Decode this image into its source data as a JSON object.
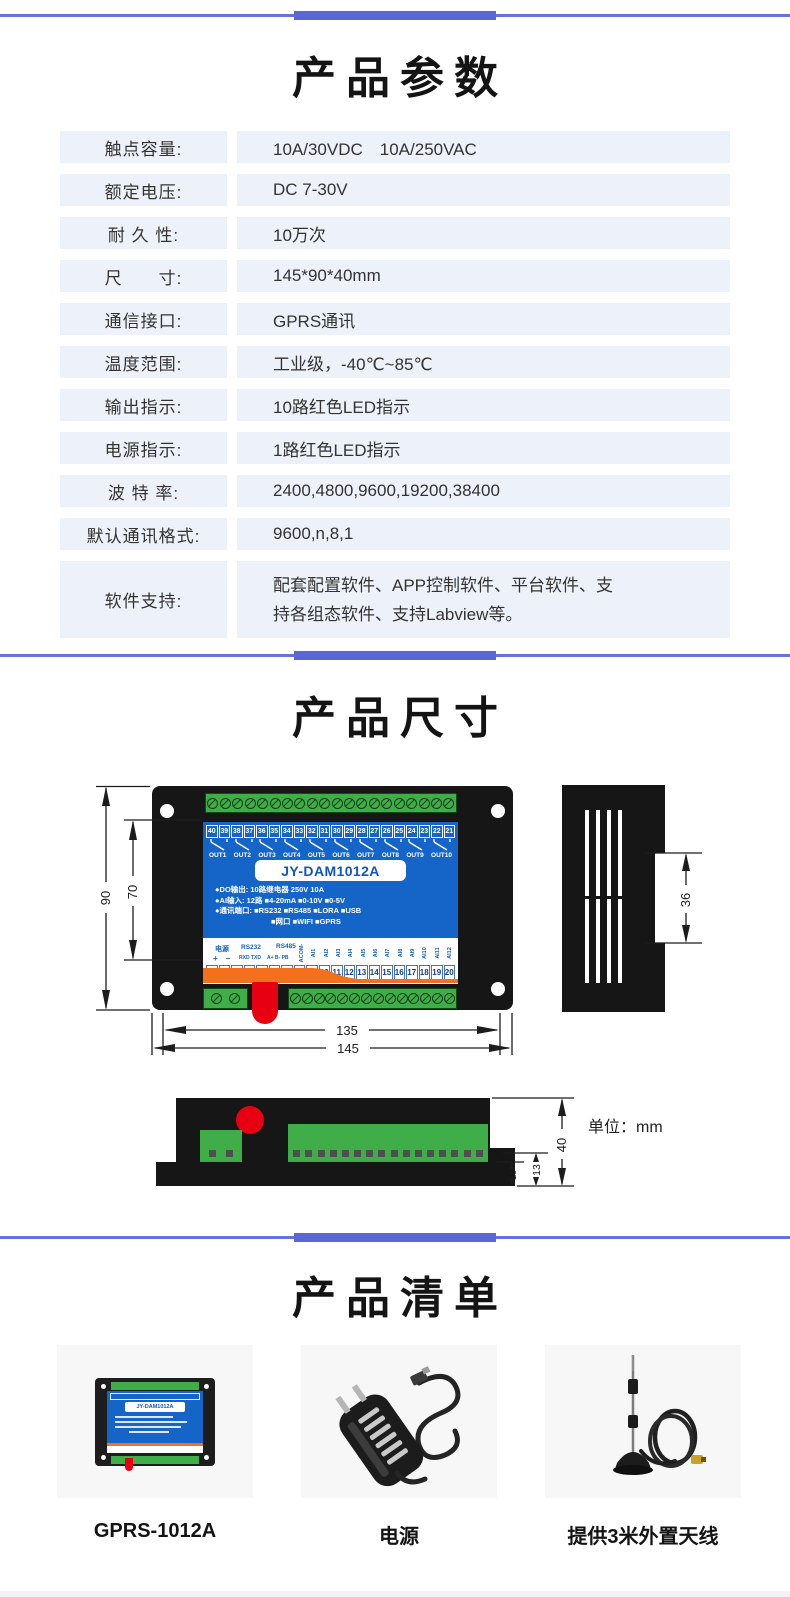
{
  "sections": {
    "params_title": "产品参数",
    "dims_title": "产品尺寸",
    "list_title": "产品清单"
  },
  "params_table": {
    "rows": [
      {
        "label": "触点容量:",
        "value": "10A/30VDC　10A/250VAC"
      },
      {
        "label": "额定电压:",
        "value": "DC 7-30V"
      },
      {
        "label": "耐 久 性:",
        "value": "10万次"
      },
      {
        "label": "尺　　寸:",
        "value": "145*90*40mm"
      },
      {
        "label": "通信接口:",
        "value": "GPRS通讯"
      },
      {
        "label": "温度范围:",
        "value": "工业级，-40℃~85℃"
      },
      {
        "label": "输出指示:",
        "value": "10路红色LED指示"
      },
      {
        "label": "电源指示:",
        "value": "1路红色LED指示"
      },
      {
        "label": "波 特 率:",
        "value": "2400,4800,9600,19200,38400"
      },
      {
        "label": "默认通讯格式:",
        "value": "9600,n,8,1"
      },
      {
        "label": "软件支持:",
        "value": "配套配置软件、APP控制软件、平台软件、支持各组态软件、支持Labview等。",
        "tall": true
      }
    ]
  },
  "device": {
    "model": "JY-DAM1012A",
    "top_terminals": [
      "40",
      "39",
      "38",
      "37",
      "36",
      "35",
      "34",
      "33",
      "32",
      "31",
      "30",
      "29",
      "28",
      "27",
      "26",
      "25",
      "24",
      "23",
      "22",
      "21"
    ],
    "out_labels": [
      "OUT1",
      "OUT2",
      "OUT3",
      "OUT4",
      "OUT5",
      "OUT6",
      "OUT7",
      "OUT8",
      "OUT9",
      "OUT10"
    ],
    "spec_lines": [
      "●DO输出: 10路继电器 250V 10A",
      "●AI输入: 12路 ■4-20mA ■0-10V ■0-5V",
      "●通讯端口: ■RS232 ■RS485 ■LORA ■USB",
      "■网口 ■WIFI ■GPRS"
    ],
    "power_label": "电源",
    "power_pins": "+　−",
    "rs232_label": "RS232",
    "rs232_pins": "RXD TXD",
    "rs485_label": "RS485",
    "rs485_pins": "A+  B-  PB",
    "vertical_pins": [
      "ACOM-",
      "AI1",
      "AI2",
      "AI3",
      "AI4",
      "AI5",
      "AI6",
      "AI7",
      "AI8",
      "AI9",
      "AI10",
      "AI11",
      "AI12"
    ],
    "bottom_terminals": [
      "1",
      "2",
      "3",
      "4",
      "5",
      "6",
      "7",
      "8",
      "9",
      "10",
      "11",
      "12",
      "13",
      "14",
      "15",
      "16",
      "17",
      "18",
      "19",
      "20"
    ]
  },
  "dims": {
    "height_outer": "90",
    "height_inner": "70",
    "width_inner": "135",
    "width_outer": "145",
    "side_width": "36",
    "bottom_height": "40",
    "step_13": "13",
    "step_10": "10",
    "unit_note": "单位：mm"
  },
  "product_list": {
    "cards": [
      {
        "caption": "GPRS-1012A",
        "image": "device-photo"
      },
      {
        "caption": "电源",
        "image": "power-adapter-photo"
      },
      {
        "caption": "提供3米外置天线",
        "image": "antenna-photo"
      }
    ]
  },
  "colors": {
    "accent_blue": "#6672da",
    "accent_bar": "#5a66d6",
    "row_bg": "#edf1fa",
    "panel_blue": "#1565c8",
    "orange": "#f4701d",
    "terminal_green": "#3fae49",
    "alarm_red": "#e60012"
  }
}
